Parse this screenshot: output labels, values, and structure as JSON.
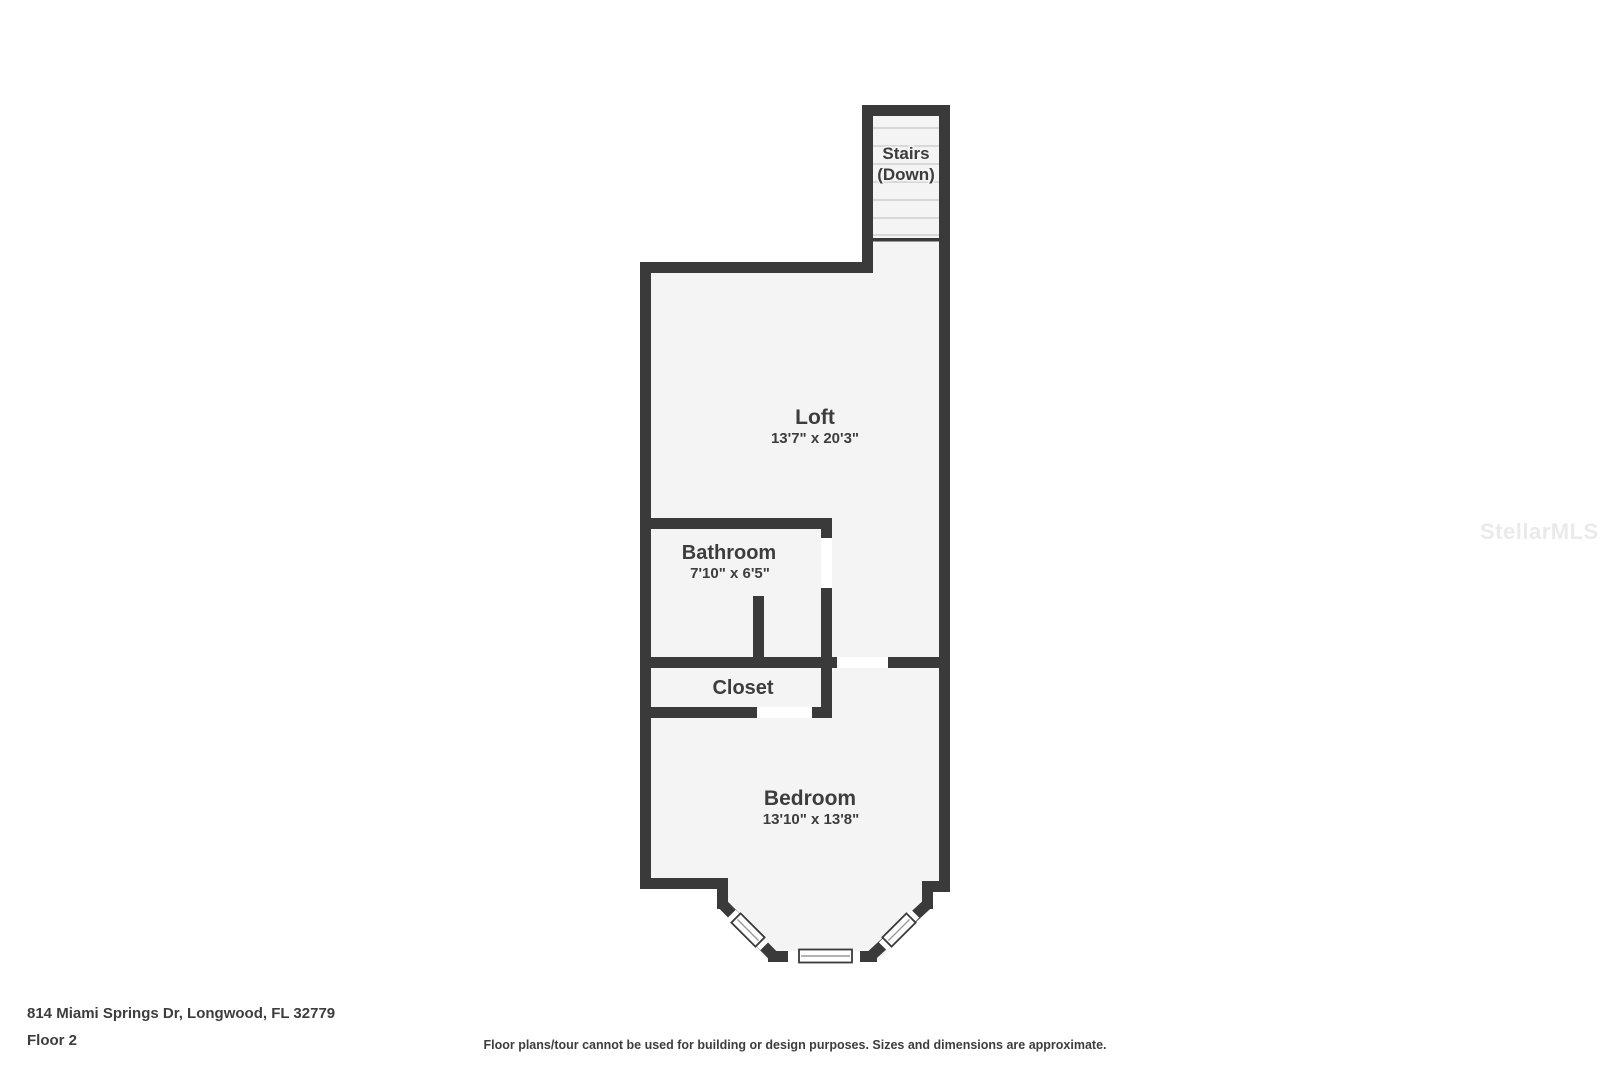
{
  "floor_plan": {
    "rooms": {
      "stairs": {
        "label": "Stairs",
        "sublabel": "(Down)"
      },
      "loft": {
        "label": "Loft",
        "dims": "13'7\" x 20'3\""
      },
      "bathroom": {
        "label": "Bathroom",
        "dims": "7'10\" x 6'5\""
      },
      "closet": {
        "label": "Closet"
      },
      "bedroom": {
        "label": "Bedroom",
        "dims": "13'10\" x 13'8\""
      }
    },
    "colors": {
      "wall": "#3a3a3a",
      "room_fill": "#f4f4f4",
      "door_gap": "#ffffff",
      "text": "#3d3d3d",
      "stair_tread": "#d8d8d8",
      "watermark": "#eaeaea",
      "background": "#ffffff"
    }
  },
  "footer": {
    "address": "814 Miami Springs Dr, Longwood, FL 32779",
    "floor": "Floor 2",
    "disclaimer": "Floor plans/tour cannot be used for building or design purposes. Sizes and dimensions are approximate."
  },
  "watermark": "StellarMLS"
}
